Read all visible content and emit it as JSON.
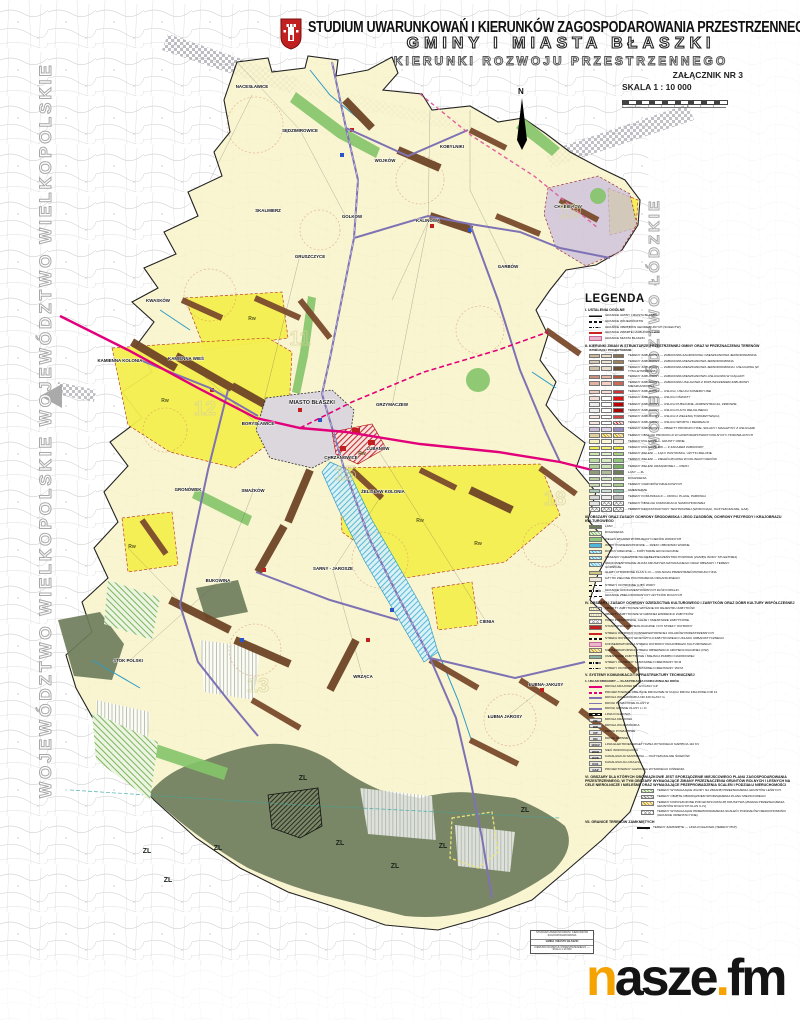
{
  "header": {
    "line1": "STUDIUM UWARUNKOWAŃ I KIERUNKÓW ZAGOSPODAROWANIA PRZESTRZENNEGO",
    "line2": "GMINY I MIASTA BŁASZKI",
    "line3": "KIERUNKI ROZWOJU PRZESTRZENNEGO",
    "attachment": "ZAŁĄCZNIK NR 3",
    "scale": "SKALA 1 : 10 000",
    "north": "N"
  },
  "side": {
    "left": "WOJEWÓDZTWO WIELKOPOLSKIE",
    "right": "WOJEWÓDZTWO ŁÓDZKIE"
  },
  "map": {
    "city": "MIASTO BŁASZKI",
    "villages": [
      {
        "n": "NACESŁAWICE",
        "x": 252,
        "y": 88
      },
      {
        "n": "SĘDZIMIROWICE",
        "x": 300,
        "y": 132
      },
      {
        "n": "KOBYLNIKI",
        "x": 452,
        "y": 148
      },
      {
        "n": "WOJKÓW",
        "x": 385,
        "y": 162
      },
      {
        "n": "KWASKÓW",
        "x": 158,
        "y": 302
      },
      {
        "n": "SKALMIERZ",
        "x": 268,
        "y": 212
      },
      {
        "n": "GOLKÓW",
        "x": 352,
        "y": 218
      },
      {
        "n": "KALINOWA",
        "x": 428,
        "y": 222
      },
      {
        "n": "CHABIERÓW",
        "x": 568,
        "y": 208
      },
      {
        "n": "GARBÓW",
        "x": 508,
        "y": 268
      },
      {
        "n": "GRUSZCZYCE",
        "x": 310,
        "y": 258
      },
      {
        "n": "KAMIENNA KOLONIA",
        "x": 120,
        "y": 362
      },
      {
        "n": "KAMIENNA WIEŚ",
        "x": 186,
        "y": 360
      },
      {
        "n": "BORYSŁAWICE",
        "x": 258,
        "y": 425
      },
      {
        "n": "GRZYMACZEW",
        "x": 392,
        "y": 406
      },
      {
        "n": "LUBANÓW",
        "x": 378,
        "y": 450
      },
      {
        "n": "CHRZANOWICE",
        "x": 341,
        "y": 459
      },
      {
        "n": "GRONÓWEK",
        "x": 188,
        "y": 491
      },
      {
        "n": "SMAŻKÓW",
        "x": 253,
        "y": 492
      },
      {
        "n": "ŻELISŁAW KOLONIA",
        "x": 383,
        "y": 493
      },
      {
        "n": "SARNY - JAROSZE",
        "x": 333,
        "y": 570
      },
      {
        "n": "BUKOWINA",
        "x": 218,
        "y": 582
      },
      {
        "n": "CIENIA",
        "x": 487,
        "y": 623
      },
      {
        "n": "WRZĄCA",
        "x": 363,
        "y": 678
      },
      {
        "n": "STOK POLSKI",
        "x": 128,
        "y": 662
      },
      {
        "n": "ŁUBNA-JAKUSY",
        "x": 546,
        "y": 686
      },
      {
        "n": "ŁUBNA JAROSY",
        "x": 505,
        "y": 718
      }
    ],
    "zl_label": "ZL",
    "zl_positions": [
      {
        "x": 147,
        "y": 853
      },
      {
        "x": 168,
        "y": 882
      },
      {
        "x": 218,
        "y": 850
      },
      {
        "x": 303,
        "y": 780
      },
      {
        "x": 340,
        "y": 845
      },
      {
        "x": 395,
        "y": 868
      },
      {
        "x": 443,
        "y": 848
      },
      {
        "x": 525,
        "y": 812
      }
    ],
    "rw_label": "Rw",
    "rw_positions": [
      {
        "x": 252,
        "y": 320
      },
      {
        "x": 165,
        "y": 402
      },
      {
        "x": 420,
        "y": 522
      },
      {
        "x": 478,
        "y": 545
      },
      {
        "x": 132,
        "y": 548
      },
      {
        "x": 362,
        "y": 455
      }
    ],
    "grid_numbers": [
      {
        "t": "11",
        "x": 300,
        "y": 345
      },
      {
        "t": "12",
        "x": 205,
        "y": 415
      },
      {
        "t": "15",
        "x": 345,
        "y": 480
      },
      {
        "t": "18",
        "x": 555,
        "y": 505
      },
      {
        "t": "19",
        "x": 570,
        "y": 218
      },
      {
        "t": "13",
        "x": 258,
        "y": 692
      }
    ]
  },
  "legend": {
    "title": "LEGENDA",
    "sec1_head": "I. USTALENIA OGÓLNE",
    "sec1": [
      {
        "cls": "line-thick",
        "t": "GRANICE GMINY I MIASTA BŁASZKI"
      },
      {
        "cls": "line-dash",
        "t": "GRANICE WOJEWÓDZTW"
      },
      {
        "cls": "line-dashdot",
        "t": "GRANICE OBRĘBÓW GEODEZYJNYCH (SOŁECTW)"
      },
      {
        "cls": "line-red",
        "t": "GRANICE ZWARTEJ ZABUDOWY WSI"
      },
      {
        "cls": "band-pink",
        "t": "GRANICE MIASTA BŁASZKI"
      }
    ],
    "sec2_head": "II. KIERUNKI ZMIAN W STRUKTURZE PRZESTRZENNEJ GMINY ORAZ W PRZEZNACZENIU TERENÓW",
    "sec2_cols": "ISTNIEJĄCE / PROJEKTOWANE",
    "sec2": [
      {
        "c": [
          "#cdb99c",
          "#e8dcc8",
          "#8b6f52"
        ],
        "t": "TERENY ZABUDOWY — ZABUDOWA ZAGRODOWA I MIESZKANIOWA JEDNORODZINNA"
      },
      {
        "c": [
          "#d8c8b0",
          "#eee3d2",
          "#a3805c"
        ],
        "t": "TERENY ZABUDOWY — ZABUDOWA MIESZKANIOWA JEDNORODZINNA"
      },
      {
        "c": [
          "#cfc0a8",
          "#e9ddc9",
          "#6e4f38"
        ],
        "t": "TERENY ZABUDOWY — ZABUDOWA MIESZKANIOWA JEDNORODZINNA I USŁUGOWA (W TYM LETNISKOWA)"
      },
      {
        "c": [
          "#c98f7a",
          "#e8b9a6",
          "#b0543c"
        ],
        "t": "TERENY ZABUDOWY — ZABUDOWA MIESZKANIOWO-USŁUGOWA W CIĄGACH"
      },
      {
        "c": [
          "#e3b1a1",
          "#f2cfc2",
          "#c66a5a"
        ],
        "t": "TERENY ZABUDOWY — ZABUDOWA USŁUGOWA Z DOPUSZCZENIEM ZABUDOWY MIESZKANIOWEJ"
      },
      {
        "c": [
          "#f0c9c0",
          "#f7dfd8",
          "#d23333"
        ],
        "t": "TERENY ZABUDOWY — USŁUGI, USŁUGI KOMERCYJNE"
      },
      {
        "c": [
          "#f2dcd8",
          "#ffffff",
          "#e11111"
        ],
        "t": "TERENY ZABUDOWY — USŁUGI OŚWIATY"
      },
      {
        "c": [
          "#eeeeee",
          "#ffffff",
          "#c00000"
        ],
        "t": "TERENY ZABUDOWY — USŁUGI PUBLICZNE, ADMINISTRACJA, ZDROWIE"
      },
      {
        "c": [
          "#eeeeee",
          "#ffffff",
          "#a80808"
        ],
        "t": "TERENY ZABUDOWY — USŁUGI KULTU RELIGIJNEGO"
      },
      {
        "c": [
          "#f6e9e5",
          "#ffffff",
          "#d24444"
        ],
        "t": "TERENY ZABUDOWY — USŁUGI Z ZIELENIĄ TOWARZYSZĄCĄ"
      },
      {
        "c": [
          "#f7e9e2",
          "#ffffff",
          "hatch-red"
        ],
        "t": "TERENY ZABUDOWY — USŁUGI SPORTU I REKREACJI"
      },
      {
        "c": [
          "#cbb9dc",
          "#ded3ea",
          "#9b8cc4"
        ],
        "t": "TERENY ZABUDOWY — OBIEKTY PRODUKCYJNE, SKŁADY I MAGAZYNY Z USŁUGAMI"
      },
      {
        "c": [
          "#e2cf9e",
          "hatch-gold",
          "hatch-gold"
        ],
        "t": "TERENY OBSŁUGI PRODUKCJI W GOSPODARSTWACH ROLNYCH I HODOWLANYCH"
      },
      {
        "c": [
          "#f6f2c0",
          "#fbf8d8",
          "#efeadc"
        ],
        "t": "TERENY ROLNICZE — GRUNTY ORNE"
      },
      {
        "c": [
          "#f3ee4e",
          "#f7f27a",
          "#efe93e"
        ],
        "t": "TERENY ROLNICZE Rw — Z ZAKAZEM ZABUDOWY"
      },
      {
        "c": [
          "#cfe6b4",
          "#e2f1cf",
          "#a9d284"
        ],
        "t": "TERENY ZIELENI — ŁĄKI I PASTWISKA, UŻYTKI ZIELONE"
      },
      {
        "c": [
          "#b9dba0",
          "#d6ecc2",
          "#8fc97b"
        ],
        "t": "TERENY ZIELENI — ZIELEŃ ŁĘGOWA W DOLINACH CIEKÓW"
      },
      {
        "c": [
          "#aacf96",
          "#cde4bb",
          "#79b164"
        ],
        "t": "TERENY ZIELENI URZĄDZONEJ — PARKI"
      },
      {
        "c": [
          "#8f9c77",
          "#b0bb9a",
          "#6f7d5c"
        ],
        "t": "LASY — ZL"
      },
      {
        "c": [
          "#b9cf9d",
          "#d8e7c4",
          "#9db87e"
        ],
        "t": "DOLESIENIA"
      },
      {
        "c": [
          "#c4dcb0",
          "#ddecce",
          "#a6cf8e"
        ],
        "t": "TERENY OGRODÓW DZIAŁKOWYCH"
      },
      {
        "c": [
          "#a9c9b8",
          "#cbdfd4",
          "#87b5a0"
        ],
        "t": "CMENTARZE"
      },
      {
        "c": [
          "#d8d8d8",
          "#ececec",
          "#bdbdbd"
        ],
        "t": "TERENY KOMUNIKACJI — DROGI, PLACE, PARKINGI"
      },
      {
        "c": [
          "#e4e4e4",
          "cross",
          "cross"
        ],
        "t": "TERENY OBSŁUGI KOMUNIKACJI SAMOCHODOWEJ"
      },
      {
        "c": [
          "cross",
          "cross",
          "cross"
        ],
        "t": "TERENY INFRASTRUKTURY TECHNICZNEJ (WODOCIĄGI, OCZYSZCZALNIE, GAZ)"
      }
    ],
    "sec3_head": "III. OBSZARY ORAZ ZASADY OCHRONY ŚRODOWISKA I JEGO ZASOBÓW, OCHRONY PRZYRODY I KRAJOBRAZU KULTUROWEGO",
    "sec3": [
      {
        "cls": "sw",
        "c": "#6f7d5c",
        "t": "LASY"
      },
      {
        "cls": "hatch-green",
        "t": "DOLESIENIA"
      },
      {
        "cls": "sw",
        "c": "#8fc97b",
        "t": "ZIELEŃ ŁĘGOWA W DOLINACH CIEKÓW WODNYCH"
      },
      {
        "cls": "sw",
        "c": "#4fb6dc",
        "t": "WODY POWIERZCHNIOWE — RZEKI I ZBIORNIKI WODNE"
      },
      {
        "cls": "hatch-blue",
        "t": "DOLINY RZECZNE — KORYTARZE EKOLOGICZNE"
      },
      {
        "cls": "hatch-blue",
        "t": "OBSZARY NARAŻONE NA NIEBEZPIECZEŃSTWO POWODZI (ZASIĘG WODY STULETNIEJ)"
      },
      {
        "cls": "hatch-blue",
        "t": "UDOKUMENTOWANE ZŁOŻA KRUSZYWA NATURALNEGO ORAZ OBSZARY I TERENY GÓRNICZE"
      },
      {
        "cls": "sw",
        "c": "#cfc77e",
        "t": "GLEBY CHRONIONE KLAS II–III — ROLNICZA PRZESTRZEŃ PRODUKCYJNA"
      },
      {
        "cls": "sw",
        "c": "#efeadc",
        "t": "UŻYTKI ZIELONE POCHODZENIA ORGANICZNEGO"
      },
      {
        "cls": "line-dash",
        "t": "STREFY OCHRONNE UJĘĆ WODY"
      },
      {
        "cls": "line-dashdot",
        "t": "GRANICE UDOKUMENTOWANYCH ZŁÓŻ KOPALIN"
      },
      {
        "cls": "line-dash",
        "t": "GRANICE ZMELIOROWANYCH UŻYTKÓW ROLNYCH"
      }
    ],
    "sec4_head": "IV. OBSZARY I ZASADY OCHRONY DZIEDZICTWA KULTUROWEGO I ZABYTKÓW ORAZ DÓBR KULTURY WSPÓŁCZESNEJ",
    "sec4": [
      {
        "cls": "dots",
        "t": "OBIEKTY ZABYTKOWE WPISANE DO REJESTRU ZABYTKÓW"
      },
      {
        "cls": "dots",
        "t": "OBIEKTY ZABYTKOWE W GMINNEJ EWIDENCJI ZABYTKÓW"
      },
      {
        "cls": "cross",
        "t": "PARKI PODWORSKIE, ALEJE I CMENTARZE ZABYTKOWE"
      },
      {
        "cls": "sw",
        "c": "#c22020",
        "t": "STANOWISKA ARCHEOLOGICZNE I ICH STREFY OCHRONY"
      },
      {
        "cls": "line-red",
        "t": "STREFA OCHRONY KONSERWATORSKIEJ UKŁADÓW PRZESTRZENNYCH"
      },
      {
        "cls": "line-dash",
        "t": "STREFA OCHRONY EKSPOZYCJI ZABYTKOWEGO UKŁADU URBANISTYCZNEGO"
      },
      {
        "cls": "band-pink",
        "t": "KONSERWATORSKA STREFA OCHRONY KRAJOBRAZU KULTUROWEGO"
      },
      {
        "cls": "hatch-gold",
        "t": "KONSERWATORSKA STREFA OBSERWACJI ARCHEOLOGICZNEJ (OW)"
      },
      {
        "cls": "sw",
        "c": "#87b5a0",
        "t": "CMENTARZE ZABYTKOWE I MIEJSCA PAMIĘCI NARODOWEJ"
      },
      {
        "cls": "line-dashdot",
        "t": "STREFY OCHRONY SANITARNEJ CMENTARZY 50 m"
      },
      {
        "cls": "line-dashdot",
        "t": "STREFY OCHRONY SANITARNEJ CMENTARZY 150 m"
      }
    ],
    "sec5_head": "V. SYSTEMY KOMUNIKACJI I INFRASTRUKTURY TECHNICZNEJ",
    "sec5a_head": "1. UKŁAD DROGOWY — KLASYFIKACJA FUNKCJONALNA DRÓG",
    "sec5": [
      {
        "cls": "line-magenta",
        "t": "DROGA KRAJOWA NR 12 KLASY GP"
      },
      {
        "cls": "line-dash-magenta",
        "t": "PROJEKTOWANE OBEJŚCIE DROGOWE W CIĄGU DROGI KRAJOWEJ NR 12"
      },
      {
        "cls": "line-purple",
        "t": "DROGA WOJEWÓDZKA NR 449 KLASY G"
      },
      {
        "cls": "line-purple-thin",
        "t": "DROGI POWIATOWE KLASY Z"
      },
      {
        "cls": "line-purple-thin",
        "t": "DROGI GMINNE KLASY L I D"
      },
      {
        "cls": "rail",
        "t": "LINIA KOLEJOWA"
      },
      {
        "cls": "box",
        "b": "DK",
        "t": "DROGA KRAJOWA"
      },
      {
        "cls": "box",
        "b": "DW",
        "t": "DROGA WOJEWÓDZKA"
      },
      {
        "cls": "box",
        "b": "DP",
        "t": "DROGI POWIATOWE"
      },
      {
        "cls": "box",
        "b": "DG",
        "t": "DROGI GMINNE"
      },
      {
        "cls": "box",
        "b": "110kV",
        "t": "LINIA ELEKTROENERGETYCZNA WYSOKIEGO NAPIĘCIA 110 kV"
      },
      {
        "cls": "box",
        "b": "WOD",
        "t": "SIEĆ WODOCIĄGOWA"
      },
      {
        "cls": "box",
        "b": "KOS",
        "t": "KANALIZACJA SANITARNA — OCZYSZCZALNIE ŚCIEKÓW"
      },
      {
        "cls": "box",
        "b": "KOL",
        "t": "KANALIZACJA LOKALNA"
      },
      {
        "cls": "box",
        "b": "GAZ",
        "t": "PROJEKTOWANY GAZOCIĄG WYSOKIEGO CIŚNIENIA"
      }
    ],
    "sec6_head": "VI. OBSZARY DLA KTÓRYCH OBOWIĄZKOWE JEST SPORZĄDZENIE MIEJSCOWEGO PLANU ZAGOSPODAROWANIA PRZESTRZENNEGO, W TYM OBSZARY WYMAGAJĄCE ZMIANY PRZEZNACZENIA GRUNTÓW ROLNYCH I LEŚNYCH NA CELE NIEROLNICZE I NIELEŚNE ORAZ WYMAGAJĄCE PRZEPROWADZENIA SCALEŃ I PODZIAŁU NIERUCHOMOŚCI",
    "sec6": [
      {
        "cls": "hatch-green",
        "t": "TERENY WYMAGAJĄCE ZGODY NA ZMIANĘ PRZEZNACZENIA GRUNTÓW LEŚNYCH"
      },
      {
        "cls": "hatch-gray",
        "t": "TERENY OBJĘTE OBOWIĄZKIEM SPORZĄDZENIA PLANU MIEJSCOWEGO"
      },
      {
        "cls": "hatch-gold",
        "t": "TERENY DOPUSZCZONE POD EKSPLOATACJĘ KRUSZYWA (ZMIANA PRZEZNACZENIA GRUNTÓW ROLNYCH KLAS II–IV)"
      },
      {
        "cls": "cross",
        "t": "TERENY WYMAGAJĄCE PRZEPROWADZENIA SCALEŃ I PODZIAŁÓW NIERUCHOMOŚCI (GRANICE ORIENTACYJNE)"
      }
    ],
    "sec7_head": "VII. GRANICE TERENÓW ZAMKNIĘTYCH",
    "sec7": [
      {
        "cls": "rail",
        "t": "TERENY ZAMKNIĘTE — LINIA KOLEJOWA (TERENY PKP)"
      }
    ]
  },
  "stamp": {
    "rows": [
      "STUDIUM UWARUNKOWAŃ I KIERUNKÓW ZAGOSPODAROWANIA",
      "GMINA I MIASTO BŁASZKI",
      "KIERUNKI ROZWOJU PRZESTRZENNEGO — SKALA 1:10 000"
    ]
  },
  "logo": {
    "p1": "n",
    "p2": "asze",
    "dot": ".",
    "p3": "fm"
  }
}
